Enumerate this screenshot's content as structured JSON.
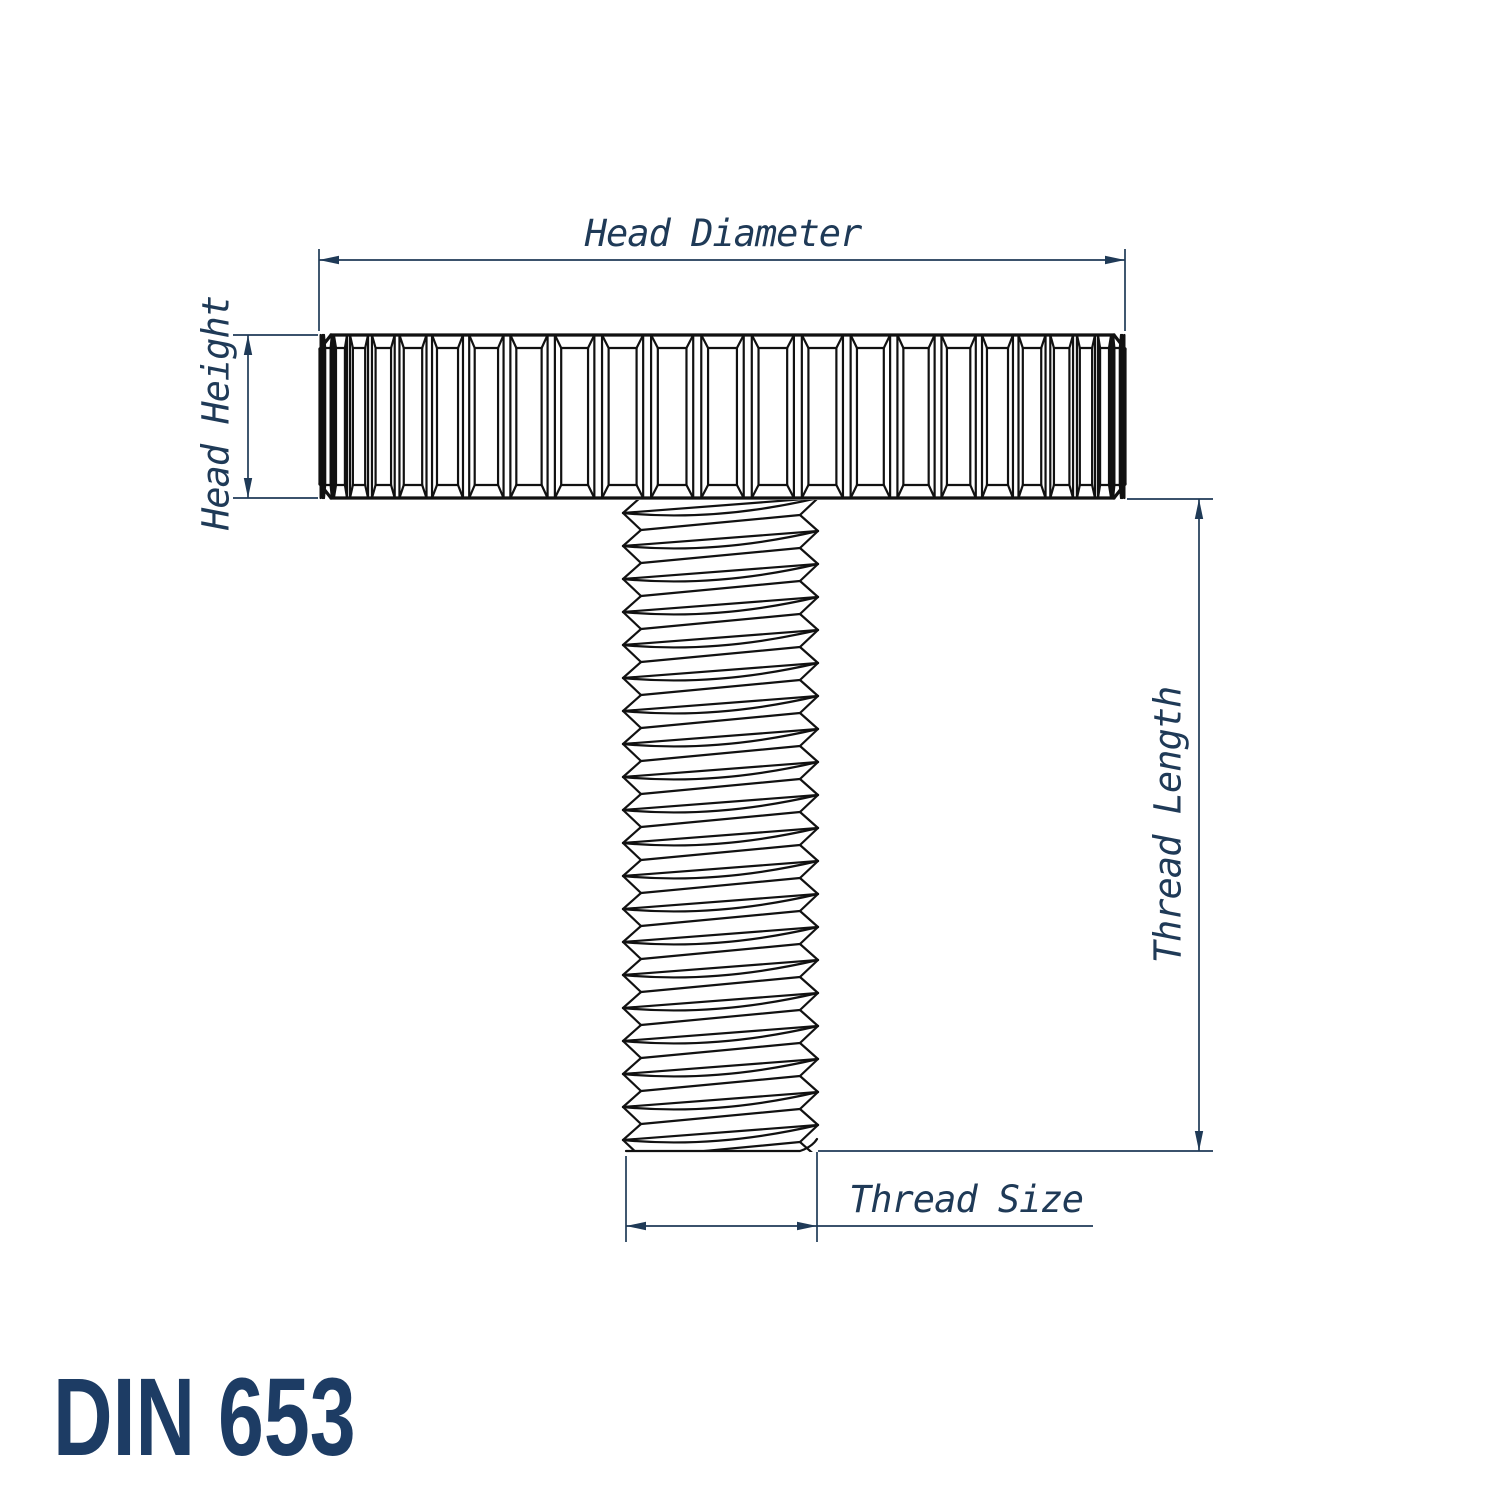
{
  "title": "DIN 653",
  "labels": {
    "head_diameter": "Head Diameter",
    "head_height": "Head Height",
    "thread_length": "Thread Length",
    "thread_size": "Thread Size"
  },
  "colors": {
    "drawing_line": "#111111",
    "dimension": "#1f3a57",
    "title": "#1d3c64",
    "background": "#ffffff"
  }
}
